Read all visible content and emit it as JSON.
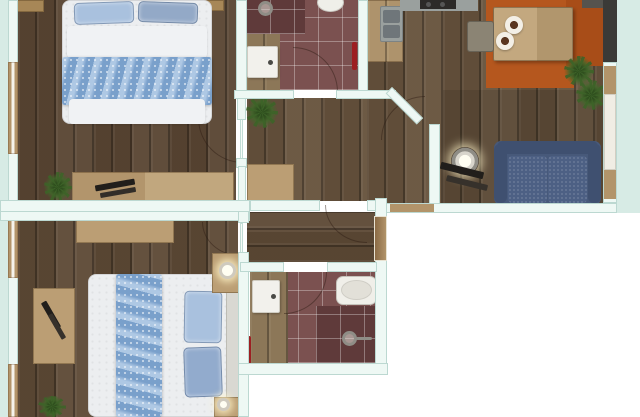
{
  "meta": {
    "image_type": "3d-rendered-floor-plan",
    "view": "top-down",
    "description": "Apartment floor plan render with two bedrooms, two bathrooms, hallway, and open kitchen-dining-living area"
  },
  "palette": {
    "background": "#ffffff",
    "halo": "#d7ebe5",
    "wall": "#eef8f4",
    "wall_border": "#bcd8d1",
    "wood_floor_dark": "#5a4633",
    "wood_floor_mid": "#67533d",
    "wood_floor_warm": "#5e4a36",
    "tile_maroon": "#7b5150",
    "tile_shower": "#5f3a3a",
    "tile_wood": "#97805f",
    "furniture_wood": "#bb9e74",
    "furniture_wood_dark": "#a78757",
    "bed_white": "#eceef0",
    "bed_blue": "#8fb3da",
    "pillow_blue": "#a9c1de",
    "sofa_blue": "#47597a",
    "sofa_blue_dark": "#3f5070",
    "cushion_blue": "#4d6084",
    "rug_orange": "#b5571e",
    "rug_orange_dark": "#a84d18",
    "counter_grey": "#9aa09e",
    "stove_dark": "#2c2a28",
    "accent_red": "#9c1f22",
    "window_wood": "#b2946a",
    "tv_black": "#211e1b"
  },
  "rooms": [
    {
      "name": "bedroom-top",
      "position": "top-left",
      "floor": "dark wood planks",
      "furniture": [
        "double bed with blue bedding",
        "bedside table left",
        "bedside table right",
        "window",
        "sideboard with black accessories",
        "potted plant",
        "door to hallway"
      ]
    },
    {
      "name": "bathroom-top",
      "position": "top-center",
      "floor": "maroon tile",
      "furniture": [
        "walk-in shower",
        "toilet",
        "washbasin",
        "red towel rail",
        "door to hallway"
      ]
    },
    {
      "name": "kitchen-dining",
      "position": "top-right",
      "floor": "wood planks",
      "furniture": [
        "counter with double sink",
        "cooktop",
        "dining table with two place settings",
        "chair",
        "orange rug",
        "two potted plants",
        "tall dark cabinet"
      ]
    },
    {
      "name": "living-area",
      "position": "right",
      "floor": "dark wood planks",
      "furniture": [
        "blue two-seat sofa",
        "glowing floor lamp",
        "dark low table",
        "window wall"
      ]
    },
    {
      "name": "hallway",
      "position": "center",
      "floor": "wood planks",
      "furniture": [
        "wooden sideboard",
        "potted plant",
        "angled doorway to living area"
      ]
    },
    {
      "name": "corridor",
      "position": "center-bottom",
      "floor": "wood planks",
      "furniture": [
        "entry door"
      ]
    },
    {
      "name": "bathroom-bottom",
      "position": "bottom-center",
      "floor": "maroon tile",
      "furniture": [
        "bathtub",
        "walk-in shower",
        "washbasin",
        "red towel rail",
        "door to corridor"
      ]
    },
    {
      "name": "bedroom-bottom",
      "position": "bottom-left",
      "floor": "wood planks",
      "furniture": [
        "double bed with blue bedding",
        "headboard",
        "nightstand with lamp top",
        "nightstand with lamp bottom",
        "dresser",
        "tv stand with black tv",
        "two windows",
        "potted plant",
        "door to corridor"
      ]
    }
  ]
}
